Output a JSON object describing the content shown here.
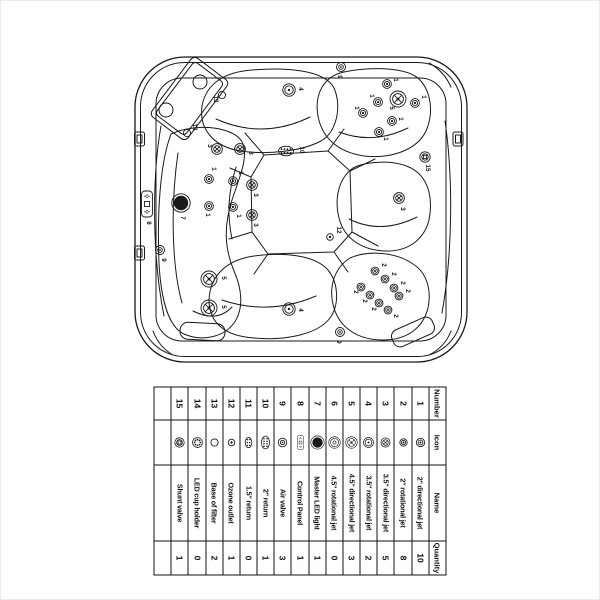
{
  "page": {
    "background": "#ffffff",
    "line_color": "#1a1a1a",
    "frame_color": "#ececec"
  },
  "table": {
    "headers": {
      "number": "Number",
      "icon": "Icon",
      "name": "Name",
      "quantity": "Quantity"
    },
    "rows": [
      {
        "number": "1",
        "icon": "jet-2in-directional-icon",
        "name": "2\" directional jet",
        "quantity": "10"
      },
      {
        "number": "2",
        "icon": "jet-2in-rotational-icon",
        "name": "2\" rotational jet",
        "quantity": "8"
      },
      {
        "number": "3",
        "icon": "jet-3-5in-directional-icon",
        "name": "3.5\" directional jet",
        "quantity": "5"
      },
      {
        "number": "4",
        "icon": "jet-3-5in-rotational-icon",
        "name": "3.5\" rotational jet",
        "quantity": "2"
      },
      {
        "number": "5",
        "icon": "jet-4-5in-directional-icon",
        "name": "4.5\" directional jet",
        "quantity": "3"
      },
      {
        "number": "6",
        "icon": "jet-4-5in-rotational-icon",
        "name": "4.5\" rotational jet",
        "quantity": "0"
      },
      {
        "number": "7",
        "icon": "master-led-light-icon",
        "name": "Master LED light",
        "quantity": "1"
      },
      {
        "number": "8",
        "icon": "control-panel-icon",
        "name": "Control Panel",
        "quantity": "1"
      },
      {
        "number": "9",
        "icon": "air-valve-icon",
        "name": "Air valve",
        "quantity": "3"
      },
      {
        "number": "10",
        "icon": "return-2in-icon",
        "name": "2\" return",
        "quantity": "1"
      },
      {
        "number": "11",
        "icon": "return-1-5in-icon",
        "name": "1.5\" return",
        "quantity": "0"
      },
      {
        "number": "12",
        "icon": "ozone-outlet-icon",
        "name": "Ozone outlet",
        "quantity": "1"
      },
      {
        "number": "13",
        "icon": "base-of-filter-icon",
        "name": "Base of filter",
        "quantity": "2"
      },
      {
        "number": "14",
        "icon": "led-cup-holder-icon",
        "name": "LED cup holder",
        "quantity": "0"
      },
      {
        "number": "15",
        "icon": "shunt-valve-icon",
        "name": "Shunt valve",
        "quantity": "1"
      }
    ]
  },
  "diagram": {
    "markers": [
      {
        "label": "1",
        "type": "jet-2in-directional-icon",
        "x": 377,
        "y": 101,
        "lx": 369,
        "ly": 95
      },
      {
        "label": "1",
        "type": "jet-2in-directional-icon",
        "x": 362,
        "y": 112,
        "lx": 354,
        "ly": 107
      },
      {
        "label": "1",
        "type": "jet-2in-directional-icon",
        "x": 414,
        "y": 102,
        "lx": 421,
        "ly": 96
      },
      {
        "label": "1",
        "type": "jet-2in-directional-icon",
        "x": 391,
        "y": 120,
        "lx": 398,
        "ly": 118
      },
      {
        "label": "1",
        "type": "jet-2in-directional-icon",
        "x": 378,
        "y": 131,
        "lx": 383,
        "ly": 138
      },
      {
        "label": "1",
        "type": "jet-2in-directional-icon",
        "x": 386,
        "y": 83,
        "lx": 393,
        "ly": 79
      },
      {
        "label": "1",
        "type": "jet-2in-directional-icon",
        "x": 208,
        "y": 178,
        "lx": 211,
        "ly": 168
      },
      {
        "label": "1",
        "type": "jet-2in-directional-icon",
        "x": 232,
        "y": 180,
        "lx": 238,
        "ly": 172
      },
      {
        "label": "1",
        "type": "jet-2in-directional-icon",
        "x": 208,
        "y": 205,
        "lx": 205,
        "ly": 214
      },
      {
        "label": "1",
        "type": "jet-2in-directional-icon",
        "x": 232,
        "y": 206,
        "lx": 236,
        "ly": 215
      },
      {
        "label": "2",
        "type": "jet-2in-rotational-icon",
        "x": 374,
        "y": 270,
        "lx": 381,
        "ly": 264
      },
      {
        "label": "2",
        "type": "jet-2in-rotational-icon",
        "x": 384,
        "y": 278,
        "lx": 391,
        "ly": 273
      },
      {
        "label": "2",
        "type": "jet-2in-rotational-icon",
        "x": 393,
        "y": 287,
        "lx": 400,
        "ly": 282
      },
      {
        "label": "2",
        "type": "jet-2in-rotational-icon",
        "x": 360,
        "y": 286,
        "lx": 353,
        "ly": 291
      },
      {
        "label": "2",
        "type": "jet-2in-rotational-icon",
        "x": 369,
        "y": 294,
        "lx": 362,
        "ly": 300
      },
      {
        "label": "2",
        "type": "jet-2in-rotational-icon",
        "x": 378,
        "y": 302,
        "lx": 371,
        "ly": 308
      },
      {
        "label": "2",
        "type": "jet-2in-rotational-icon",
        "x": 387,
        "y": 309,
        "lx": 393,
        "ly": 315
      },
      {
        "label": "2",
        "type": "jet-2in-rotational-icon",
        "x": 398,
        "y": 295,
        "lx": 405,
        "ly": 290
      },
      {
        "label": "3",
        "type": "jet-3-5in-directional-icon",
        "x": 216,
        "y": 148,
        "lx": 207,
        "ly": 145
      },
      {
        "label": "3",
        "type": "jet-3-5in-directional-icon",
        "x": 239,
        "y": 148,
        "lx": 248,
        "ly": 152
      },
      {
        "label": "3",
        "type": "jet-3-5in-directional-icon",
        "x": 251,
        "y": 184,
        "lx": 253,
        "ly": 194
      },
      {
        "label": "3",
        "type": "jet-3-5in-directional-icon",
        "x": 251,
        "y": 214,
        "lx": 253,
        "ly": 224
      },
      {
        "label": "3",
        "type": "jet-3-5in-directional-icon",
        "x": 398,
        "y": 197,
        "lx": 400,
        "ly": 208
      },
      {
        "label": "4",
        "type": "jet-3-5in-rotational-icon",
        "x": 288,
        "y": 89,
        "lx": 298,
        "ly": 88
      },
      {
        "label": "4",
        "type": "jet-3-5in-rotational-icon",
        "x": 288,
        "y": 308,
        "lx": 298,
        "ly": 309
      },
      {
        "label": "5",
        "type": "jet-4-5in-directional-icon",
        "x": 397,
        "y": 98,
        "lx": 389,
        "ly": 107
      },
      {
        "label": "5",
        "type": "jet-4-5in-directional-icon",
        "x": 208,
        "y": 278,
        "lx": 221,
        "ly": 277
      },
      {
        "label": "5",
        "type": "jet-4-5in-directional-icon",
        "x": 208,
        "y": 307,
        "lx": 221,
        "ly": 306
      },
      {
        "label": "7",
        "type": "master-led-light-icon",
        "x": 180,
        "y": 202,
        "lx": 180,
        "ly": 217
      },
      {
        "label": "8",
        "type": "control-panel-icon",
        "x": 146,
        "y": 203,
        "lx": 146,
        "ly": 222
      },
      {
        "label": "9",
        "type": "air-valve-icon",
        "x": 340,
        "y": 66,
        "lx": 337,
        "ly": 76
      },
      {
        "label": "9",
        "type": "air-valve-icon",
        "x": 159,
        "y": 249,
        "lx": 161,
        "ly": 259
      },
      {
        "label": "9",
        "type": "air-valve-icon",
        "x": 339,
        "y": 331,
        "lx": 336,
        "ly": 341
      },
      {
        "label": "10",
        "type": "return-2in-icon",
        "x": 285,
        "y": 150,
        "lx": 299,
        "ly": 149
      },
      {
        "label": "12",
        "type": "ozone-outlet-icon",
        "x": 329,
        "y": 236,
        "lx": 336,
        "ly": 229
      },
      {
        "label": "13",
        "type": "base-of-filter-icon",
        "x": 221,
        "y": 94,
        "lx": 213,
        "ly": 98
      },
      {
        "label": "13",
        "type": "base-of-filter-icon",
        "x": 186,
        "y": 132,
        "lx": 192,
        "ly": 126
      },
      {
        "label": "15",
        "type": "shunt-valve-icon",
        "x": 424,
        "y": 156,
        "lx": 425,
        "ly": 167
      }
    ]
  }
}
